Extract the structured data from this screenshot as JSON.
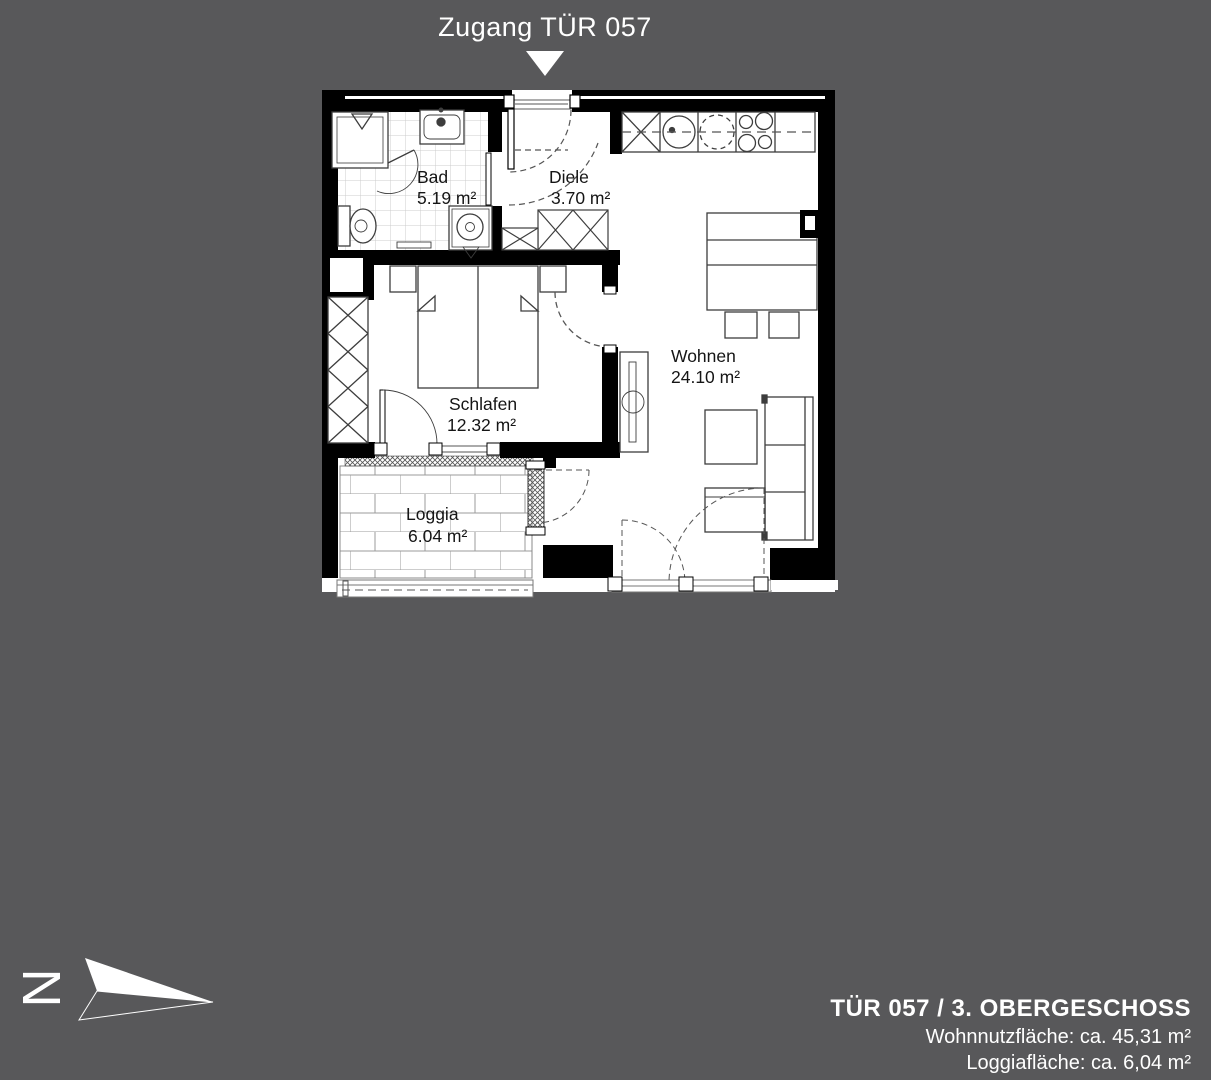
{
  "header": {
    "access_label": "Zugang TÜR 057"
  },
  "plan": {
    "rooms": [
      {
        "name": "Bad",
        "area": "5.19 m²"
      },
      {
        "name": "Diele",
        "area": "3.70 m²"
      },
      {
        "name": "Wohnen",
        "area": "24.10 m²"
      },
      {
        "name": "Schlafen",
        "area": "12.32 m²"
      },
      {
        "name": "Loggia",
        "area": "6.04 m²"
      }
    ]
  },
  "compass": {
    "north_label": "N"
  },
  "footer": {
    "unit_title": "TÜR 057 / 3. OBERGESCHOSS",
    "living_area_line": "Wohnnutzfläche: ca. 45,31 m²",
    "loggia_area_line": "Loggiafläche: ca. 6,04 m²"
  },
  "colors": {
    "background": "#58585a",
    "plan_fill": "#ffffff",
    "wall": "#000000",
    "text_on_dark": "#ffffff",
    "plan_text": "#151515"
  }
}
